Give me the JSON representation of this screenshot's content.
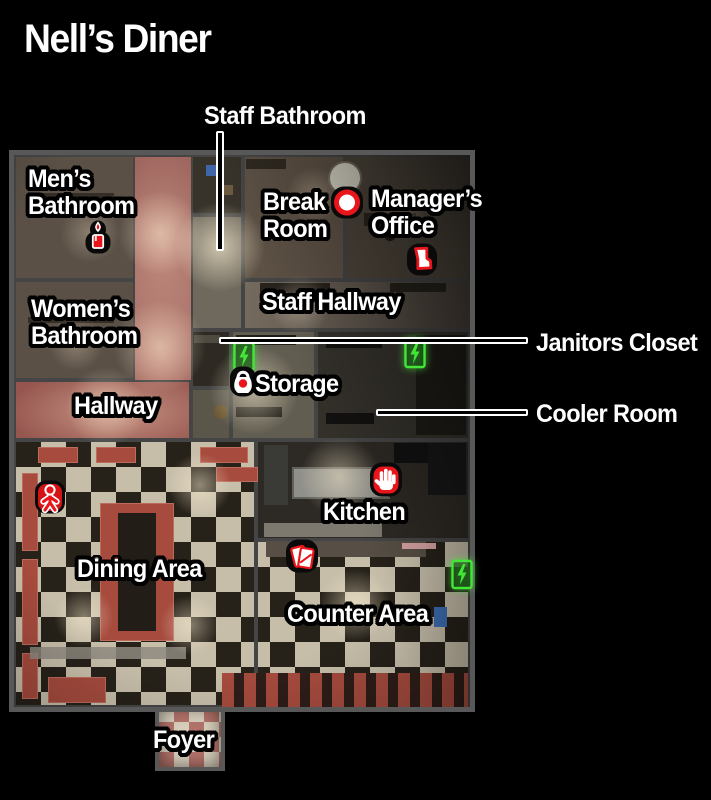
{
  "page": {
    "title": "Nell’s Diner"
  },
  "rooms": {
    "mens_bathroom": {
      "line1": "Men’s",
      "line2": "Bathroom"
    },
    "womens_bathroom": {
      "line1": "Women’s",
      "line2": "Bathroom"
    },
    "break_room": {
      "line1": "Break",
      "line2": "Room"
    },
    "managers_office": {
      "line1": "Manager’s",
      "line2": "Office"
    },
    "staff_bathroom": "Staff Bathroom",
    "staff_hallway": "Staff Hallway",
    "hallway": "Hallway",
    "storage": "Storage",
    "janitors_closet": "Janitors Closet",
    "cooler_room": "Cooler Room",
    "kitchen": "Kitchen",
    "dining_area": "Dining Area",
    "counter_area": "Counter Area",
    "foyer": "Foyer"
  },
  "icons": {
    "red_item_markers": [
      "candle",
      "plate",
      "boot",
      "padlock",
      "handprint",
      "doll",
      "tarot-cards"
    ],
    "utility_markers": [
      "fusebox",
      "fusebox",
      "fusebox"
    ]
  },
  "colors": {
    "background": "#000000",
    "label_text": "#ffffff",
    "label_outline": "#000000",
    "item_icon_red": "#e8151b",
    "fusebox_green": "#43e636",
    "hall_carpet": "#a4625c",
    "checker_light": "#c7beaa",
    "checker_dark": "#262119",
    "booth_red": "#a64b3e",
    "wall_gray": "#4a4a4a"
  }
}
